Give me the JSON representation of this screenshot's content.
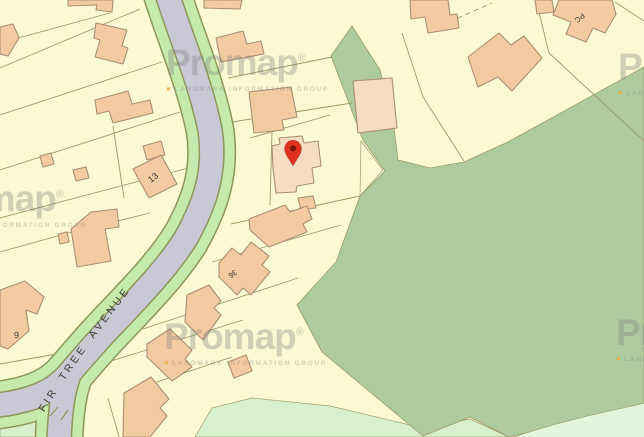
{
  "map": {
    "type": "property-boundary-map",
    "road_label": "FIR TREE AVENUE",
    "labels": {
      "plot13": "13",
      "plot9": "9",
      "plot36": "36",
      "pc": "PC"
    },
    "marker": {
      "type": "location-pin"
    },
    "watermark": {
      "brand": "Promap",
      "registered": "®",
      "bullet": "●",
      "tagline": "LANDMARK INFORMATION GROUP"
    },
    "colors": {
      "bg-yellow": "#faf9d3",
      "parcel-line": "#9b9b66",
      "sage": "#aecba0",
      "mint": "#d9f0ce",
      "mint-light": "#e2f6db",
      "road": "#c8c9d4",
      "verge": "#c5eaad",
      "casing": "#8f9659",
      "bldg": "#f3cba1",
      "bldg-light": "#f6dcc3",
      "bldg-stroke": "#a98f74",
      "label": "#3c3c32",
      "pin-red": "#e0301e",
      "pin-hole": "#7a150c",
      "watermark": "rgba(122,122,122,0.33)",
      "watermark-bullet": "rgba(235,169,63,0.8)"
    }
  }
}
